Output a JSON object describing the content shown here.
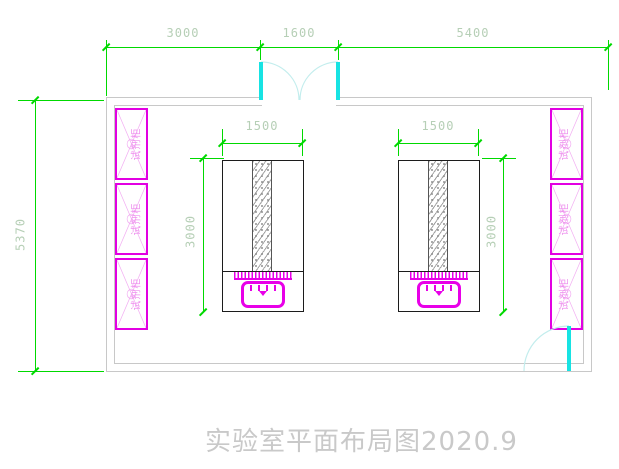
{
  "title": "实验室平面布局图2020.9",
  "dimensions": {
    "top": {
      "left": "3000",
      "middle": "1600",
      "right": "5400"
    },
    "room_depth": "5370",
    "bench_width": "1500",
    "bench_depth": "3000"
  },
  "cabinets": {
    "label": "试剂柜",
    "count_left": 3,
    "count_right": 3
  },
  "colors": {
    "dimension_green": "#00d900",
    "dimension_text": "#b6cfb6",
    "wall_gray": "#c8c8c8",
    "cabinet_magenta": "#e200e2",
    "cabinet_text_pink": "#ee8fee",
    "door_cyan": "#17e3e3",
    "equipment_magenta": "#e800e8",
    "title_gray": "#c9c9c9"
  }
}
